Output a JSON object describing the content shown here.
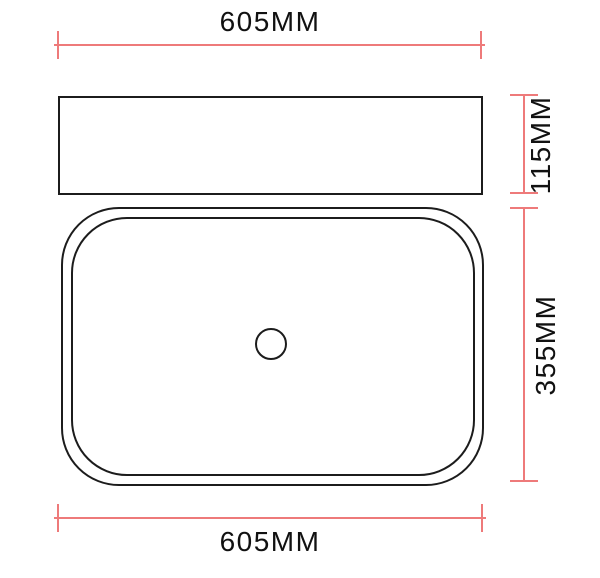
{
  "drawing": {
    "kind": "technical-dimension-drawing",
    "dimensions": {
      "top_width": {
        "label": "605MM",
        "value_mm": 605,
        "orientation": "horizontal"
      },
      "side_height": {
        "label": "115MM",
        "value_mm": 115,
        "orientation": "vertical"
      },
      "plan_depth": {
        "label": "355MM",
        "value_mm": 355,
        "orientation": "vertical"
      },
      "bottom_width": {
        "label": "605MM",
        "value_mm": 605,
        "orientation": "horizontal"
      }
    },
    "colors": {
      "dimension_line": "#ee7a7a",
      "outline": "#1c1c1c",
      "label_text": "#111111",
      "background": "#ffffff"
    }
  }
}
